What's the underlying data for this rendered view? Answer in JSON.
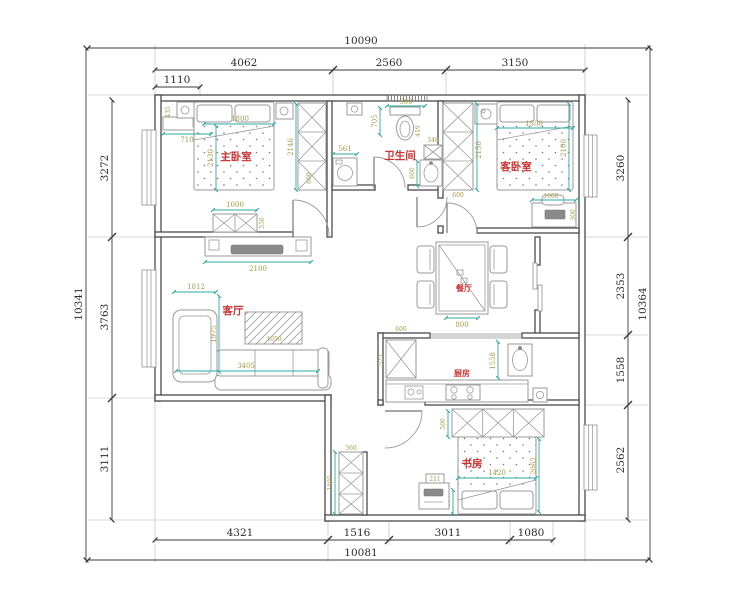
{
  "title": "apartment-floor-plan",
  "colors": {
    "dimline": "#2ba8a5",
    "dimtext": "#a59a45",
    "roomlabel": "#cc3333",
    "wall": "#4a4a4a",
    "furniture": "#9a9a9a"
  },
  "dims": {
    "top": {
      "total": "10090",
      "s1": "4062",
      "s2": "2560",
      "s3": "3150",
      "sub": "1110"
    },
    "bottom": {
      "total": "10081",
      "s1": "4321",
      "s2": "1516",
      "s3": "3011",
      "s4": "1080"
    },
    "left": {
      "total": "10341",
      "s1": "3272",
      "s2": "3763",
      "s3": "3111"
    },
    "right": {
      "total": "10364",
      "s1": "3260",
      "s2": "2353",
      "s3": "1558",
      "s4": "2562"
    }
  },
  "rooms": {
    "master": {
      "label": "主卧室",
      "bed_w": "1800",
      "bed_l": "2130",
      "ward_l": "2146",
      "ward_w": "600",
      "dresser": "710",
      "head": "435",
      "cab_w": "1000",
      "cab_d": "550"
    },
    "bath": {
      "label": "卫生间",
      "toilet_w": "500",
      "toilet_d": "705",
      "washer": "561",
      "shelf": "348",
      "side": "419",
      "sink": "600"
    },
    "guest": {
      "label": "客卧室",
      "bed_w": "1500",
      "bed_l": "2100",
      "ward_l": "2150",
      "ward_w": "600",
      "desk_w": "1000",
      "desk_d": "300"
    },
    "dining": {
      "label": "餐厅",
      "clear": "800"
    },
    "living": {
      "label": "客厅",
      "tv_wall": "2100",
      "chaise": "1012",
      "depth": "1975",
      "sofa": "3405",
      "table": "1050"
    },
    "kitchen": {
      "label": "厨房",
      "fridge": "600",
      "left": "523",
      "height": "1558"
    },
    "study": {
      "label": "书房",
      "ward": "500",
      "bed_w": "1420",
      "bed_l": "2062",
      "side": "800",
      "desk": "211",
      "hall_ward": "1405",
      "hall_top": "360"
    }
  }
}
